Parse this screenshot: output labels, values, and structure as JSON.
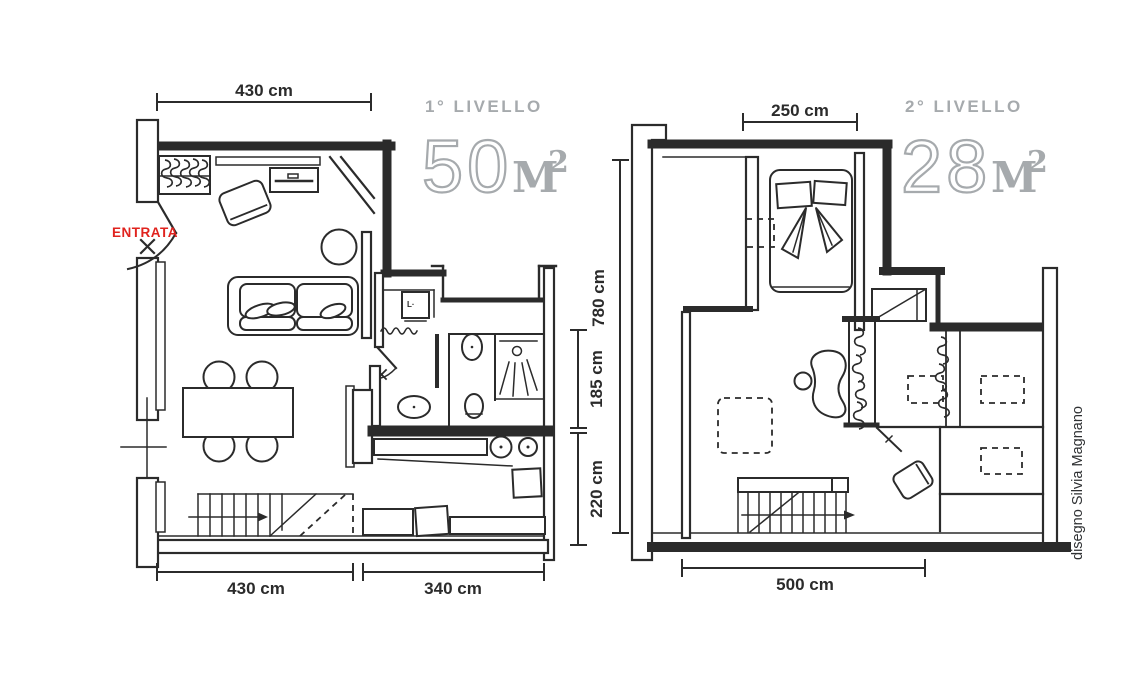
{
  "palette": {
    "line": "#2b2b2b",
    "label_gray": "#a6aaad",
    "accent_red": "#e0231e",
    "credit_dark": "#2f3133"
  },
  "level1": {
    "title": "1° LIVELLO",
    "area": "50",
    "area_unit": "M",
    "area_exp": "2",
    "entrance": "ENTRATA",
    "washer_mark": "L·",
    "dim_top": "430 cm",
    "dim_bottom_left": "430 cm",
    "dim_bottom_right": "340 cm",
    "dim_right_upper": "185 cm",
    "dim_right_lower": "220 cm"
  },
  "level2": {
    "title": "2° LIVELLO",
    "area": "28",
    "area_unit": "M",
    "area_exp": "2",
    "dim_top": "250 cm",
    "dim_bottom": "500 cm",
    "dim_left": "780 cm"
  },
  "credit": "disegno Silvia Magnano"
}
